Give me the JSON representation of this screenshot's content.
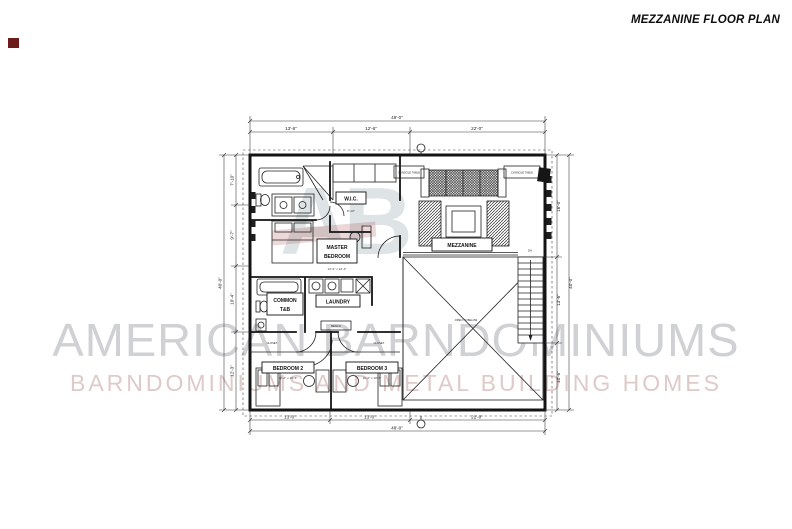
{
  "page": {
    "title": "MEZZANINE FLOOR PLAN"
  },
  "watermark": {
    "logo": "AB",
    "line1": "AMERICAN BARNDOMINIUMS",
    "line2": "BARNDOMINIUMS AND METAL BUILDING HOMES"
  },
  "plan": {
    "rooms": {
      "master_bedroom": {
        "label1": "MASTER",
        "label2": "BEDROOM",
        "size": "13'-2\" x 12'-4\""
      },
      "wic": {
        "label": "W.I.C.",
        "size": "8'-10\""
      },
      "laundry": {
        "label": "LAUNDRY",
        "bench": "BENCH"
      },
      "common_tb": {
        "label1": "COMMON",
        "label2": "T&B"
      },
      "bedroom2": {
        "label": "BEDROOM 2",
        "size": "11'-2\" x 10'-6\""
      },
      "bedroom3": {
        "label": "BEDROOM 3",
        "size": "11'-2\" x 10'-6\""
      },
      "mezzanine": {
        "label": "MEZZANINE"
      },
      "open_below": "OPEN TO BELOW",
      "closet_left": "CLOSET",
      "closet_right": "CLOSET",
      "console_left": "CONSOLE TABLE",
      "console_right": "CONSOLE TABLE",
      "stairs_dn": "DN"
    },
    "dims": {
      "top_overall": "48'-0\"",
      "top_segs": [
        "13'-6\"",
        "12'-6\"",
        "22'-0\""
      ],
      "bottom_overall": "48'-0\"",
      "bottom_segs": [
        "13'-0\"",
        "13'-0\"",
        "22'-0\""
      ],
      "left_overall": "40'-0\"",
      "left_segs": [
        "7'-10\"",
        "9'-7\"",
        "10'-4\"",
        "12'-3\""
      ],
      "right_overall": "40'-0\"",
      "right_segs": [
        "16'-0\"",
        "13'-6\"",
        "10'-6\""
      ]
    }
  },
  "colors": {
    "wall": "#141414",
    "watermark_gray": "#c7c9cd",
    "watermark_pink": "#dcc4c4",
    "corner_mark": "#6e1b1b"
  }
}
